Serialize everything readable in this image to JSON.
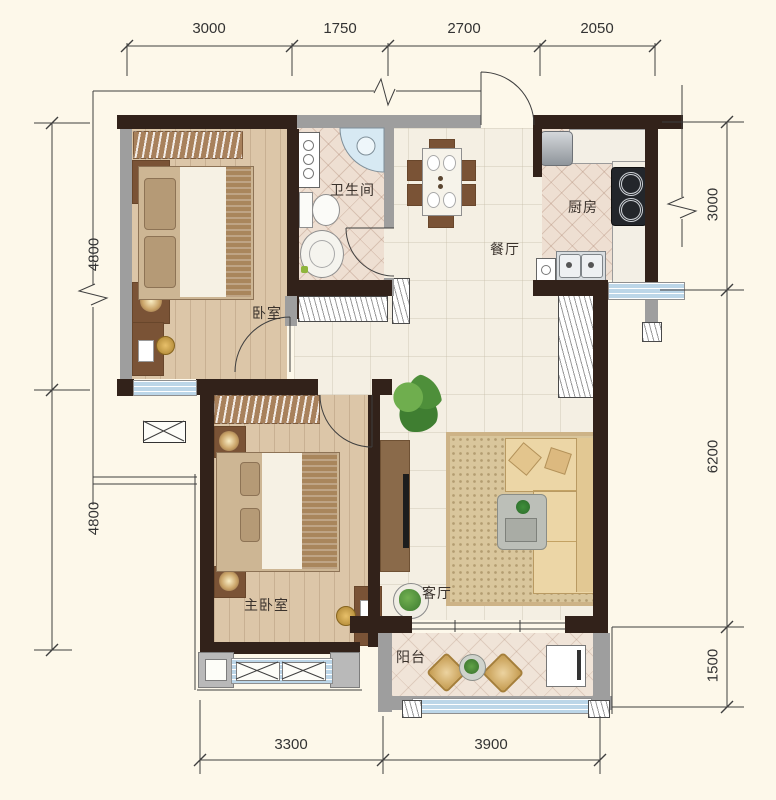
{
  "rooms": {
    "bedroom": "卧室",
    "bathroom": "卫生间",
    "dining": "餐厅",
    "kitchen": "厨房",
    "master_bedroom": "主卧室",
    "living": "客厅",
    "balcony": "阳台"
  },
  "dimensions": {
    "top": [
      "3000",
      "1750",
      "2700",
      "2050"
    ],
    "left": [
      "4800",
      "4800"
    ],
    "right": [
      "3000",
      "6200",
      "1500"
    ],
    "bottom": [
      "3300",
      "3900"
    ]
  },
  "colors": {
    "background": "#fdf8ea",
    "wall": "#32221a",
    "window_glass": "#bcd6e8",
    "wood_floor": "#dcc6a8",
    "tile_floor": "#eedfd2"
  }
}
